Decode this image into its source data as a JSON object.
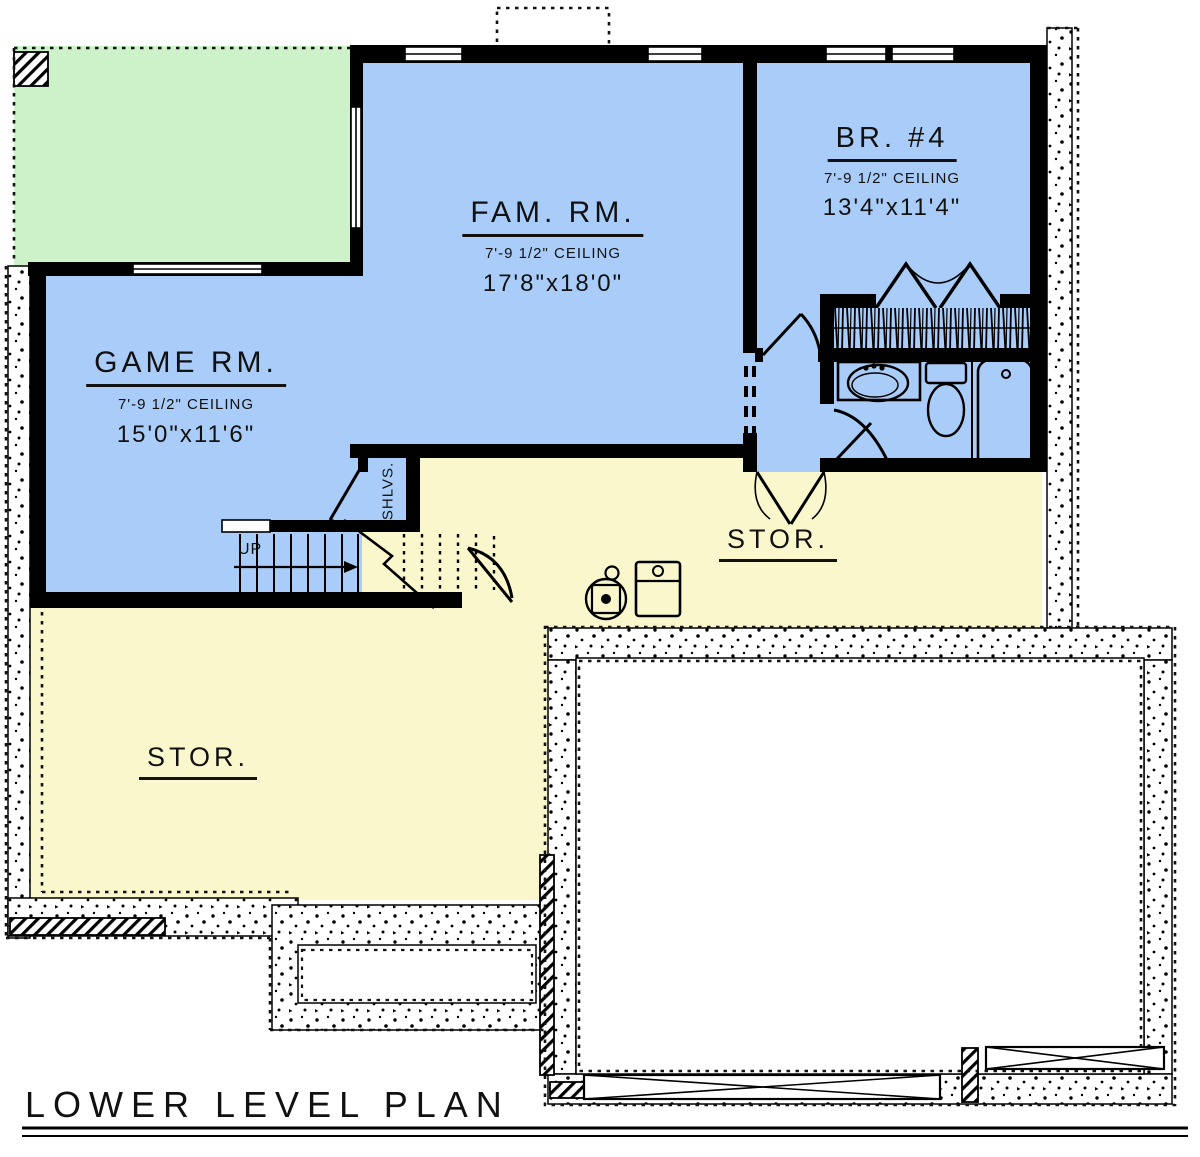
{
  "title": {
    "text": "LOWER LEVEL PLAN"
  },
  "rooms": {
    "family_room": {
      "name": "FAM. RM.",
      "ceiling": "7'-9 1/2\" CEILING",
      "dimensions": "17'8\"x18'0\""
    },
    "bedroom_4": {
      "name": "BR. #4",
      "ceiling": "7'-9 1/2\" CEILING",
      "dimensions": "13'4\"x11'4\""
    },
    "game_room": {
      "name": "GAME RM.",
      "ceiling": "7'-9 1/2\" CEILING",
      "dimensions": "15'0\"x11'6\""
    },
    "storage_center": {
      "name": "STOR."
    },
    "storage_lower_left": {
      "name": "STOR."
    }
  },
  "annotations": {
    "stairs_direction": "UP",
    "shelves": "SHLVS."
  },
  "colors": {
    "room_blue": "#a9cdf8",
    "patio_green": "#cdf2c9",
    "storage_yellow": "#f9f7cb",
    "wall_black": "#000000",
    "background": "#ffffff"
  }
}
